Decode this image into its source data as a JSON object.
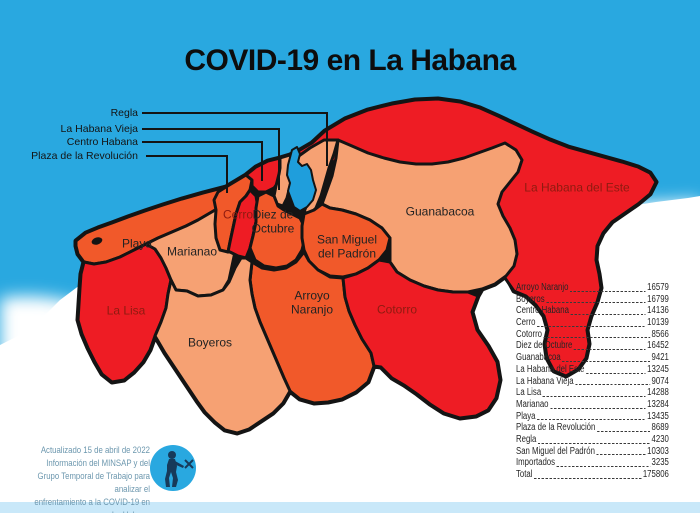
{
  "title": "COVID-19 en La Habana",
  "palette": {
    "sea": "#29A8E0",
    "bay": "#1F9EDC",
    "red": "#EE1C24",
    "orange": "#F1592A",
    "salmon": "#F6A173",
    "outline": "#141414",
    "bottom_strip": "#C9E8F9",
    "dark_label": "#8E1B10",
    "credit_text": "#6C97AE",
    "logo_figure": "#173A5A"
  },
  "callouts": [
    {
      "id": "regla",
      "label": "Regla"
    },
    {
      "id": "habana-vieja",
      "label": "La Habana Vieja"
    },
    {
      "id": "centro-habana",
      "label": "Centro Habana"
    },
    {
      "id": "plaza",
      "label": "Plaza de la Revolución"
    }
  ],
  "map": {
    "regions": [
      {
        "id": "playa",
        "fill": "orange",
        "label": "Playa",
        "label_color": "normal",
        "x": 137,
        "y": 244
      },
      {
        "id": "la-lisa",
        "fill": "red",
        "label": "La Lisa",
        "label_color": "dark",
        "x": 126,
        "y": 311
      },
      {
        "id": "marianao",
        "fill": "salmon",
        "label": "Marianao",
        "label_color": "normal",
        "x": 192,
        "y": 252
      },
      {
        "id": "plaza",
        "fill": "orange",
        "label": "",
        "label_color": "normal",
        "x": 0,
        "y": 0
      },
      {
        "id": "cerro",
        "fill": "red",
        "label": "Cerro",
        "label_color": "dark",
        "x": 238,
        "y": 215
      },
      {
        "id": "centro-habana",
        "fill": "red",
        "label": "",
        "label_color": "normal",
        "x": 0,
        "y": 0
      },
      {
        "id": "habana-vieja",
        "fill": "salmon",
        "label": "",
        "label_color": "normal",
        "x": 0,
        "y": 0
      },
      {
        "id": "regla",
        "fill": "salmon",
        "label": "",
        "label_color": "normal",
        "x": 0,
        "y": 0
      },
      {
        "id": "diez-de-octubre",
        "fill": "orange",
        "label": "Diez de\nOctubre",
        "label_color": "normal",
        "x": 273,
        "y": 222
      },
      {
        "id": "san-miguel",
        "fill": "orange",
        "label": "San Miguel\ndel Padrón",
        "label_color": "normal",
        "x": 347,
        "y": 247
      },
      {
        "id": "guanabacoa",
        "fill": "salmon",
        "label": "Guanabacoa",
        "label_color": "normal",
        "x": 440,
        "y": 212
      },
      {
        "id": "habana-del-este",
        "fill": "red",
        "label": "La Habana del Este",
        "label_color": "dark",
        "x": 577,
        "y": 188
      },
      {
        "id": "arroyo-naranjo",
        "fill": "orange",
        "label": "Arroyo\nNaranjo",
        "label_color": "normal",
        "x": 312,
        "y": 303
      },
      {
        "id": "cotorro",
        "fill": "red",
        "label": "Cotorro",
        "label_color": "dark",
        "x": 397,
        "y": 310
      },
      {
        "id": "boyeros",
        "fill": "salmon",
        "label": "Boyeros",
        "label_color": "normal",
        "x": 210,
        "y": 343
      }
    ]
  },
  "stats": {
    "rows": [
      {
        "name": "Arroyo Naranjo",
        "value": "16579"
      },
      {
        "name": "Boyeros",
        "value": "16799"
      },
      {
        "name": "Centro Habana",
        "value": "14136"
      },
      {
        "name": "Cerro",
        "value": "10139"
      },
      {
        "name": "Cotorro",
        "value": "8566"
      },
      {
        "name": "Diez de Octubre",
        "value": "16452"
      },
      {
        "name": "Guanabacoa",
        "value": "9421"
      },
      {
        "name": "La Habana del Este",
        "value": "13245"
      },
      {
        "name": "La Habana Vieja",
        "value": "9074"
      },
      {
        "name": "La Lisa",
        "value": "14288"
      },
      {
        "name": "Marianao",
        "value": "13284"
      },
      {
        "name": "Playa",
        "value": "13435"
      },
      {
        "name": "Plaza de la Revolución",
        "value": "8689"
      },
      {
        "name": "Regla",
        "value": "4230"
      },
      {
        "name": "San Miguel del Padrón",
        "value": "10303"
      },
      {
        "name": "Importados",
        "value": "3235"
      },
      {
        "name": "Total",
        "value": "175806"
      }
    ]
  },
  "credits": {
    "text": "Actualizado 15 de abril de 2022\nInformación del MINSAP y del\nGrupo Temporal de Trabajo para analizar el\nenfrentamiento a la COVID-19 en La Habana"
  }
}
